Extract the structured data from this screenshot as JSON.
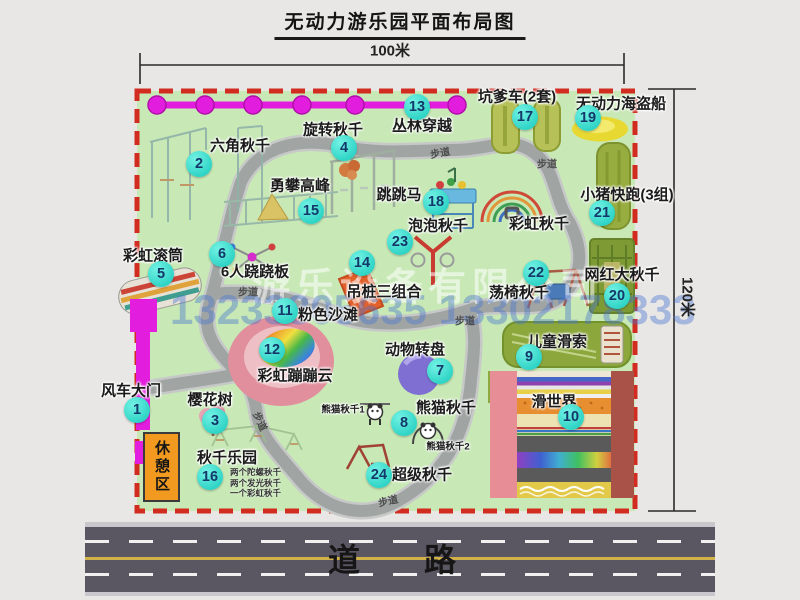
{
  "title": "无动力游乐园平面布局图",
  "dimensions": {
    "width_label": "100米",
    "height_label": "120米"
  },
  "road": {
    "label": "道　路"
  },
  "watermark": {
    "company": "游乐设备有限公司",
    "phone": "13233805635 13302178333"
  },
  "rest_area_label": "休憩区",
  "colors": {
    "map_green": "#c8e8b6",
    "border_red": "#d22c20",
    "path_gray": "#a0a5a4",
    "path_edge": "#c6c9c7",
    "badge_teal": "#2fd4c6",
    "magenta": "#e21ddd",
    "road_gray": "#5a5662",
    "rest_orange": "#f29a20"
  },
  "attractions": [
    {
      "num": "1",
      "name": "风车大门",
      "label": {
        "x": 131,
        "y": 391
      },
      "badge": {
        "x": 137,
        "y": 410
      }
    },
    {
      "num": "2",
      "name": "六角秋千",
      "label": {
        "x": 240,
        "y": 146
      },
      "badge": {
        "x": 199,
        "y": 164
      }
    },
    {
      "num": "3",
      "name": "樱花树",
      "label": {
        "x": 210,
        "y": 400
      },
      "badge": {
        "x": 215,
        "y": 421
      }
    },
    {
      "num": "4",
      "name": "旋转秋千",
      "label": {
        "x": 333,
        "y": 130
      },
      "badge": {
        "x": 344,
        "y": 148
      }
    },
    {
      "num": "5",
      "name": "彩虹滚筒",
      "label": {
        "x": 153,
        "y": 256
      },
      "badge": {
        "x": 161,
        "y": 274
      }
    },
    {
      "num": "6",
      "name": "6人跷跷板",
      "label": {
        "x": 255,
        "y": 272
      },
      "badge": {
        "x": 222,
        "y": 254
      }
    },
    {
      "num": "7",
      "name": "动物转盘",
      "label": {
        "x": 415,
        "y": 350
      },
      "badge": {
        "x": 440,
        "y": 371
      }
    },
    {
      "num": "8",
      "name": "熊猫秋千",
      "label": {
        "x": 446,
        "y": 408
      },
      "badge": {
        "x": 404,
        "y": 423
      }
    },
    {
      "num": "9",
      "name": "儿童滑索",
      "label": {
        "x": 557,
        "y": 342
      },
      "badge": {
        "x": 529,
        "y": 357
      }
    },
    {
      "num": "10",
      "name": "滑世界",
      "label": {
        "x": 554,
        "y": 402
      },
      "badge": {
        "x": 571,
        "y": 417
      }
    },
    {
      "num": "11",
      "name": "粉色沙滩",
      "label": {
        "x": 328,
        "y": 315
      },
      "badge": {
        "x": 285,
        "y": 311
      }
    },
    {
      "num": "12",
      "name": "彩虹蹦蹦云",
      "label": {
        "x": 295,
        "y": 376
      },
      "badge": {
        "x": 272,
        "y": 350
      }
    },
    {
      "num": "13",
      "name": "丛林穿越",
      "label": {
        "x": 422,
        "y": 126
      },
      "badge": {
        "x": 417,
        "y": 107
      }
    },
    {
      "num": "14",
      "name": "吊桩三组合",
      "label": {
        "x": 384,
        "y": 292
      },
      "badge": {
        "x": 362,
        "y": 263
      }
    },
    {
      "num": "15",
      "name": "勇攀高峰",
      "label": {
        "x": 300,
        "y": 186
      },
      "badge": {
        "x": 311,
        "y": 211
      }
    },
    {
      "num": "16",
      "name": "秋千乐园",
      "label": {
        "x": 227,
        "y": 458
      },
      "badge": {
        "x": 210,
        "y": 477
      }
    },
    {
      "num": "17",
      "name": "坑爹车(2套)",
      "label": {
        "x": 517,
        "y": 97
      },
      "badge": {
        "x": 525,
        "y": 117
      }
    },
    {
      "num": "18",
      "name": "跳跳马",
      "label": {
        "x": 399,
        "y": 195
      },
      "badge": {
        "x": 436,
        "y": 202
      }
    },
    {
      "num": "19",
      "name": "无动力海盗船",
      "label": {
        "x": 621,
        "y": 104
      },
      "badge": {
        "x": 588,
        "y": 118
      }
    },
    {
      "num": "20",
      "name": "网红大秋千",
      "label": {
        "x": 622,
        "y": 275
      },
      "badge": {
        "x": 617,
        "y": 296
      }
    },
    {
      "num": "21",
      "name": "小猪快跑(3组)",
      "label": {
        "x": 627,
        "y": 195
      },
      "badge": {
        "x": 602,
        "y": 213
      }
    },
    {
      "num": "22",
      "name": "荡椅秋千",
      "label": {
        "x": 519,
        "y": 293
      },
      "badge": {
        "x": 536,
        "y": 273
      }
    },
    {
      "num": "23",
      "name": "泡泡秋千",
      "label": {
        "x": 438,
        "y": 226
      },
      "badge": {
        "x": 400,
        "y": 242
      }
    },
    {
      "num": "24",
      "name": "超级秋千",
      "label": {
        "x": 422,
        "y": 475
      },
      "badge": {
        "x": 379,
        "y": 475
      }
    }
  ],
  "extra_labels": [
    {
      "text": "彩虹秋千",
      "x": 539,
      "y": 224,
      "size": "normal"
    },
    {
      "text": "熊猫秋千1",
      "x": 343,
      "y": 410,
      "size": "small"
    },
    {
      "text": "熊猫秋千2",
      "x": 448,
      "y": 447,
      "size": "small"
    }
  ],
  "path_labels": [
    {
      "text": "步道",
      "x": 440,
      "y": 152,
      "rot": -10
    },
    {
      "text": "步道",
      "x": 547,
      "y": 163,
      "rot": 0
    },
    {
      "text": "步道",
      "x": 248,
      "y": 291,
      "rot": 0
    },
    {
      "text": "步道",
      "x": 465,
      "y": 320,
      "rot": 0
    },
    {
      "text": "步道",
      "x": 261,
      "y": 421,
      "rot": 65
    },
    {
      "text": "步道",
      "x": 388,
      "y": 500,
      "rot": -12
    }
  ],
  "swing_park_notes": [
    "两个陀螺秋千",
    "两个发光秋千",
    "一个彩虹秋千"
  ]
}
